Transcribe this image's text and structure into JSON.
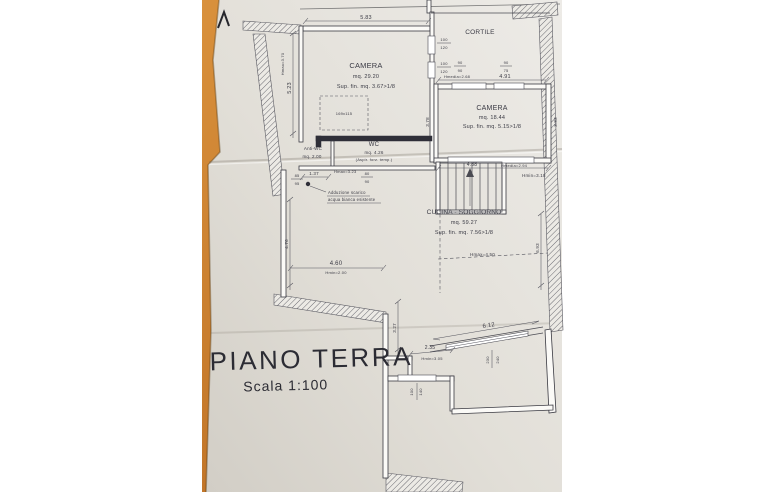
{
  "colors": {
    "wood": "#c27629",
    "paper": "#e4e1da",
    "ink": "#3b3b45"
  },
  "title_block": {
    "title": "PIANO TERRA",
    "scale": "Scala 1:100"
  },
  "rooms": {
    "camera1": {
      "name": "CAMERA",
      "area": "mq. 29.20",
      "window_ratio": "Sup. fin. mq. 3.67>1/8"
    },
    "camera2": {
      "name": "CAMERA",
      "area": "mq. 18.44",
      "window_ratio": "Sup. fin. mq. 5.15>1/8"
    },
    "cortile": {
      "name": "CORTILE"
    },
    "wc": {
      "name": "WC",
      "area": "mq. 4.26",
      "vent_note": "(Aspir. forz. temp.)"
    },
    "antiwc": {
      "name": "Anti-WC",
      "area": "mq. 2.00"
    },
    "cucina": {
      "name": "CUCINA - SOGGIORNO",
      "area": "mq. 59.27",
      "window_ratio": "Sup. fin. mq. 7.56>1/8"
    }
  },
  "note": {
    "line1": "Adduzione scarico",
    "line2": "acqua bianca esistente"
  },
  "dimensions": {
    "top": "5.83",
    "left": "5.23",
    "leftH": "Hmax=3.70",
    "c2top": "4.91",
    "c2topH": "Hmedia=2.68",
    "c2left": "3.78",
    "c2right": "3.83",
    "c2bottom": "4.88",
    "c2bottomH": "Hmedia=2.94",
    "stairsH": "Hmin=3.18",
    "antiwc": "1.37",
    "noteH": "Hmax=3.23",
    "cucLeft": "4.76",
    "cucRight": "6.93",
    "cucHmax": "Hmax=4.50",
    "cucBottom": "4.60",
    "cucBottomH": "Hmin=2.00",
    "extLeft": "3.27",
    "extStep": "2.35",
    "extStepH": "Hmin=3.05",
    "extWidth": "6.12",
    "furniture": "169x115"
  },
  "windows": [
    {
      "w": "100",
      "h": "120"
    },
    {
      "w": "100",
      "h": "120"
    },
    {
      "w": "90",
      "h": "90"
    },
    {
      "w": "90",
      "h": "75"
    },
    {
      "w": "85",
      "h": "95"
    },
    {
      "w": "80",
      "h": "90"
    },
    {
      "w": "230",
      "h": "240"
    },
    {
      "w": "100",
      "h": "140"
    }
  ]
}
